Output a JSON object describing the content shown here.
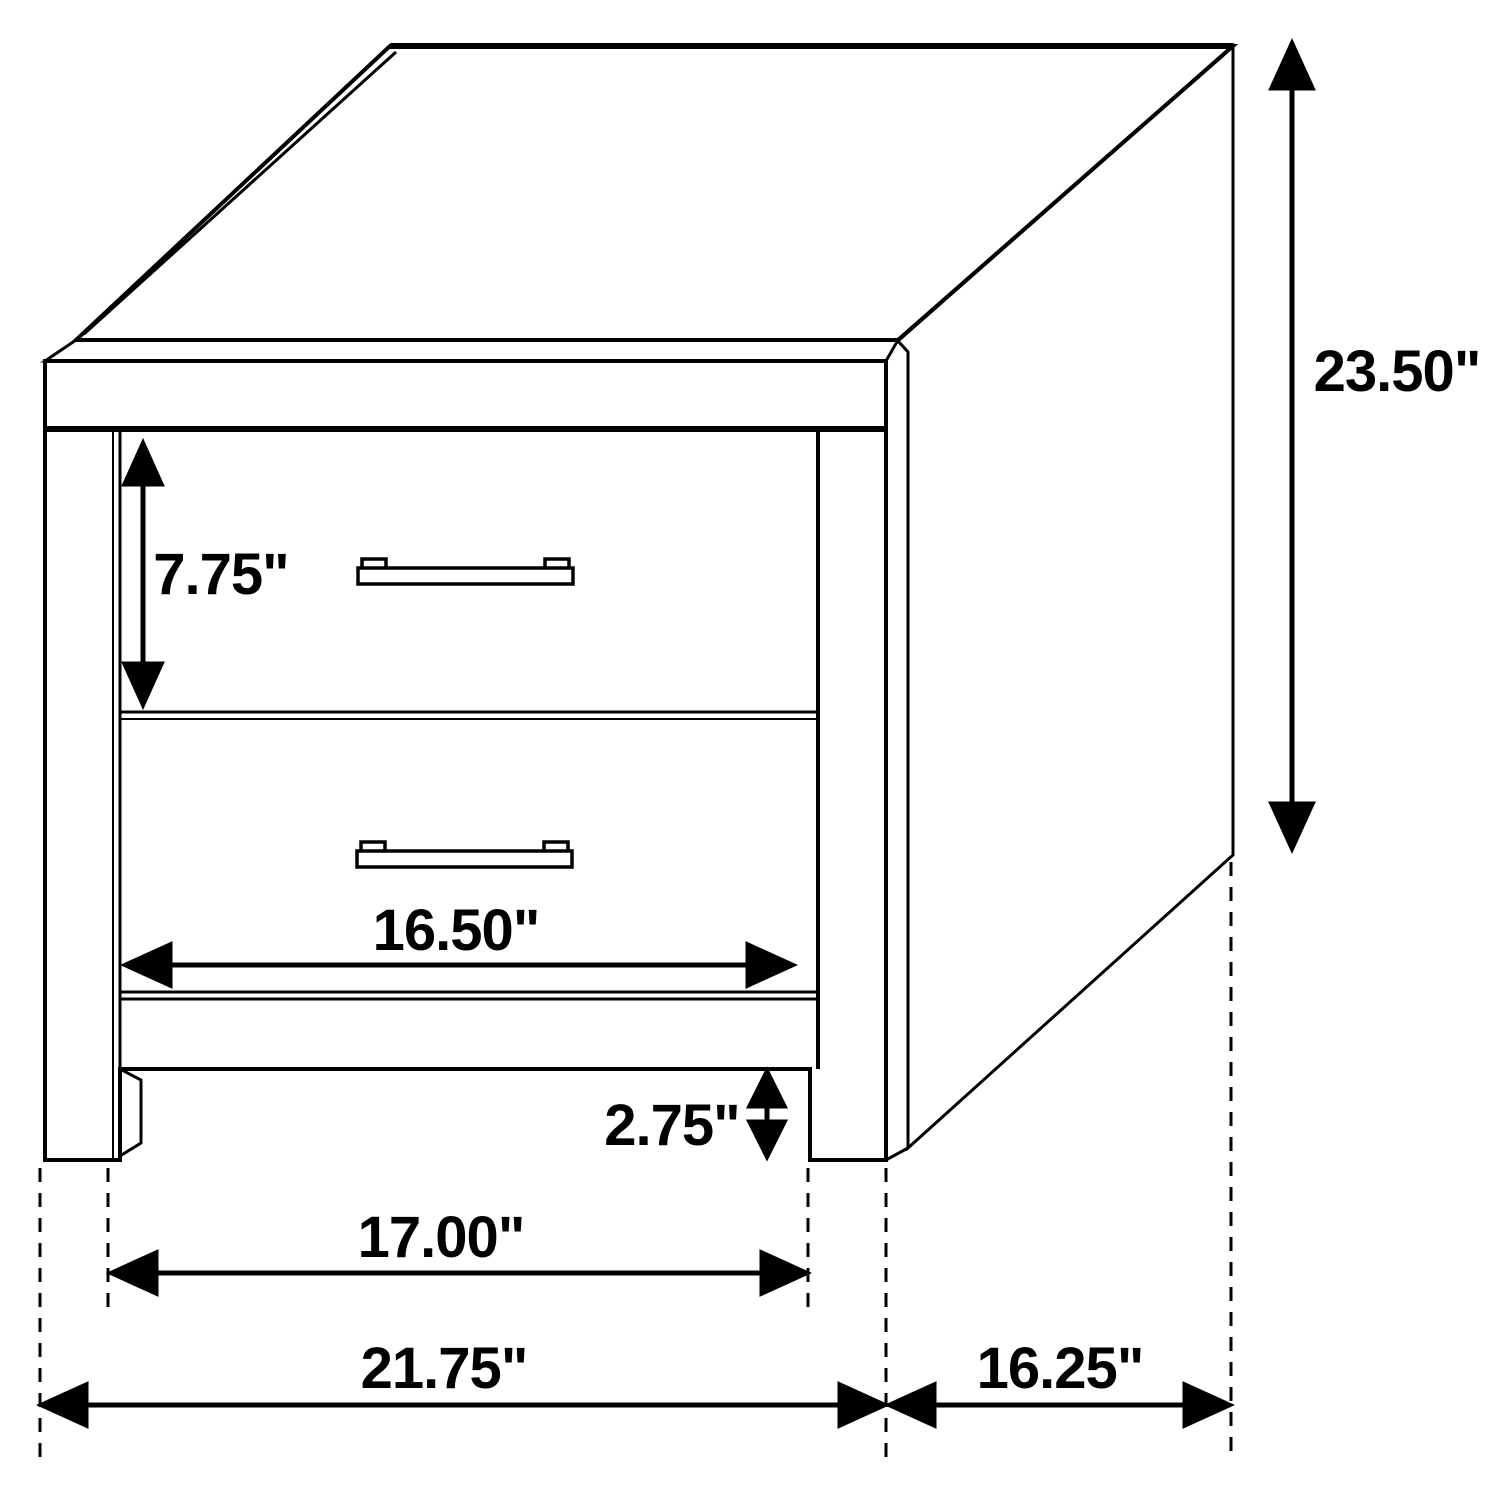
{
  "diagram": {
    "title": "Two-drawer nightstand dimension diagram",
    "unit": "inches",
    "colors": {
      "line": "#000000",
      "background": "#ffffff"
    },
    "labels": {
      "overall_height": "23.50\"",
      "drawer_front_height": "7.75\"",
      "drawer_front_width": "16.50\"",
      "floor_clearance": "2.75\"",
      "inner_leg_width": "17.00\"",
      "overall_width": "21.75\"",
      "side_depth": "16.25\""
    }
  }
}
